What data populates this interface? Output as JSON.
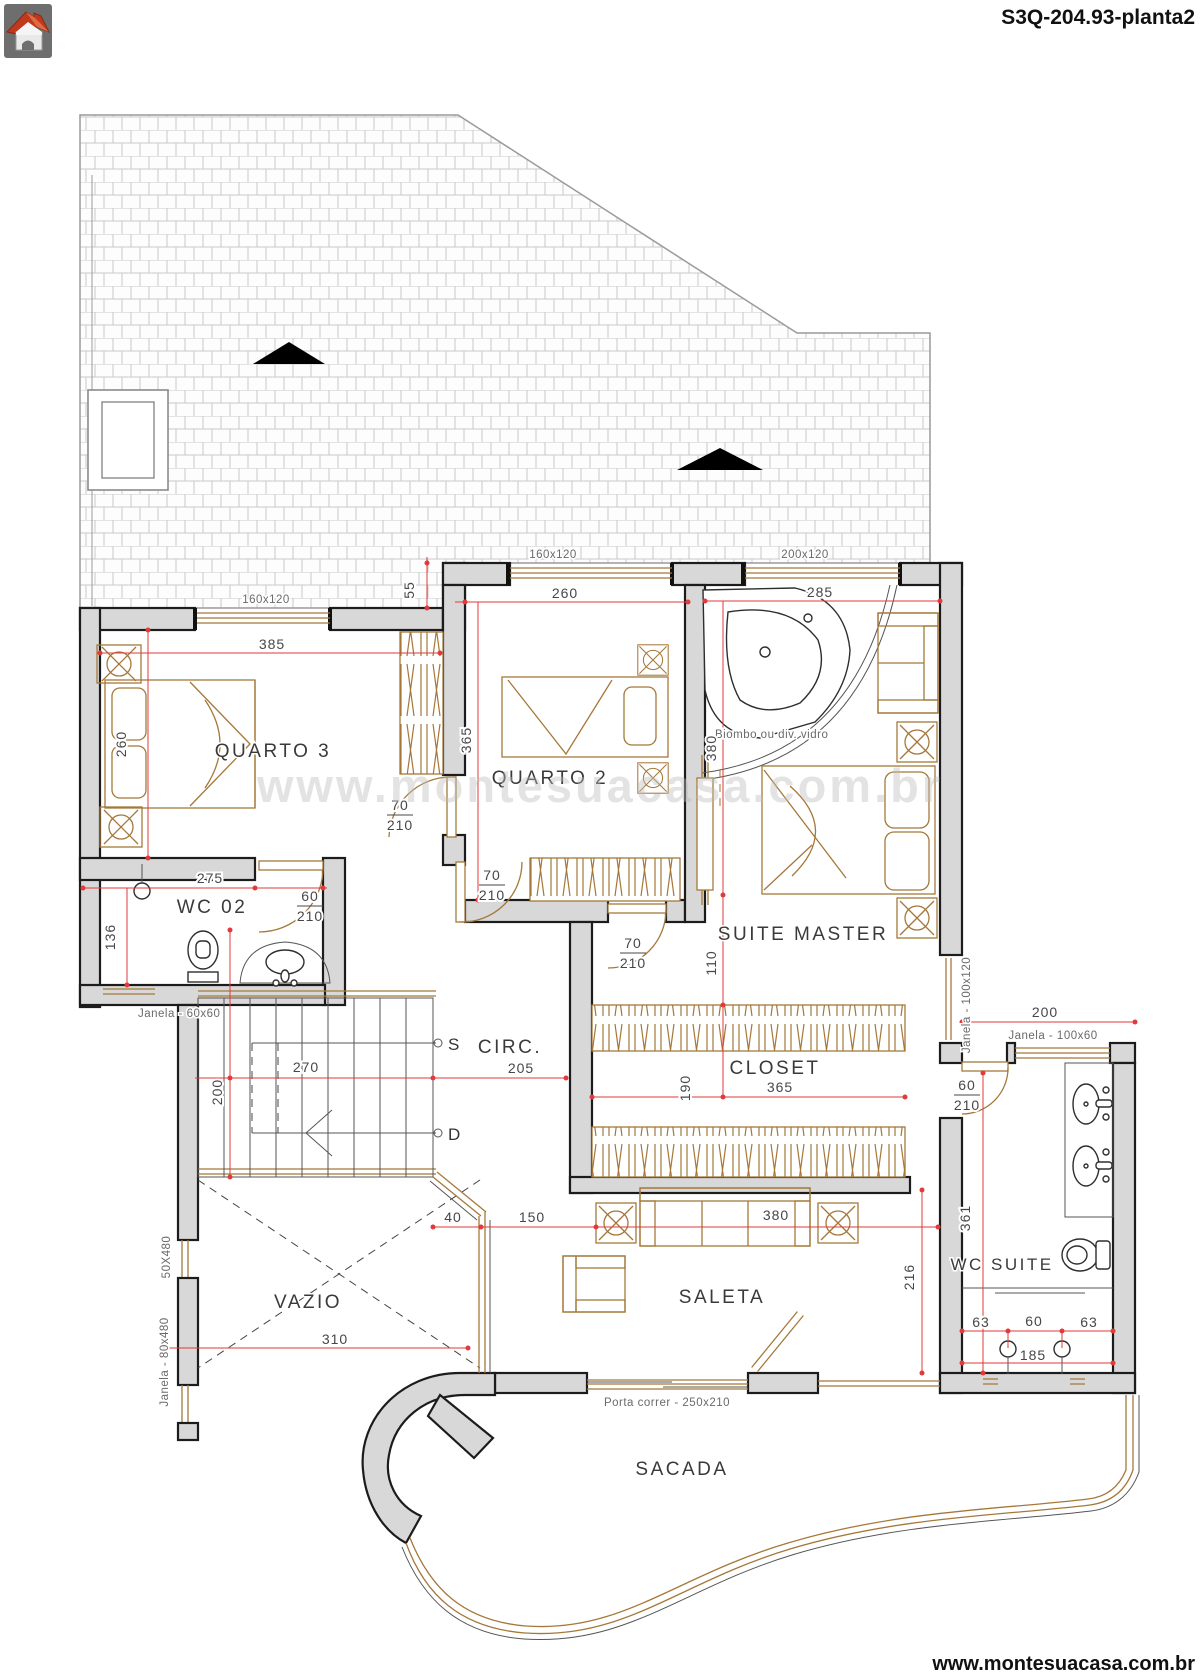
{
  "header": {
    "title": "S3Q-204.93-planta2"
  },
  "footer": {
    "url": "www.montesuacasa.com.br"
  },
  "plan": {
    "watermark": "www.montesuacasa.com.br",
    "rooms": {
      "quarto3": "QUARTO 3",
      "quarto2": "QUARTO 2",
      "suite_master": "SUITE MASTER",
      "wc02": "WC 02",
      "circ": "CIRC.",
      "closet": "CLOSET",
      "vazio": "VAZIO",
      "saleta": "SALETA",
      "wc_suite": "WC SUITE",
      "sacada": "SACADA"
    },
    "stairs": {
      "up": "S",
      "down": "D"
    },
    "windows": {
      "q3_top": "160x120",
      "q2_top": "160x120",
      "suite_top": "200x120",
      "wc02": "Janela - 60x60",
      "suite_right": "Janela - 100x120",
      "wc_suite": "Janela - 100x60",
      "vazio_upper": "50X480",
      "vazio_lower": "Janela - 80x480"
    },
    "notes": {
      "biombo": "Biombo ou div. vidro",
      "porta_correr": "Porta correr - 250x210"
    },
    "doors": {
      "w70": "70",
      "w60": "60",
      "h210": "210"
    },
    "dims": {
      "q3_w": "385",
      "q3_h": "260",
      "step": "55",
      "q2_w": "260",
      "q2_h": "365",
      "suite_w": "285",
      "suite_d": "380",
      "hall": "110",
      "closet_h": "190",
      "closet_w": "365",
      "wc02_w": "275",
      "wc02_h": "136",
      "st_w": "270",
      "st_h": "200",
      "circ": "205",
      "g40": "40",
      "g150": "150",
      "sofa": "380",
      "vazio_w": "310",
      "saleta_h": "216",
      "wcs_h": "361",
      "wcs_w": "200",
      "sh_l": "63",
      "sh_m": "60",
      "sh_r": "63",
      "sh_w": "185"
    },
    "colors": {
      "wall_fill": "#d8d8d8",
      "outline": "#1c1c1c",
      "wood": "#a5783a",
      "dim_red": "#e03a3a",
      "roof_line": "#9a9a9a"
    }
  }
}
